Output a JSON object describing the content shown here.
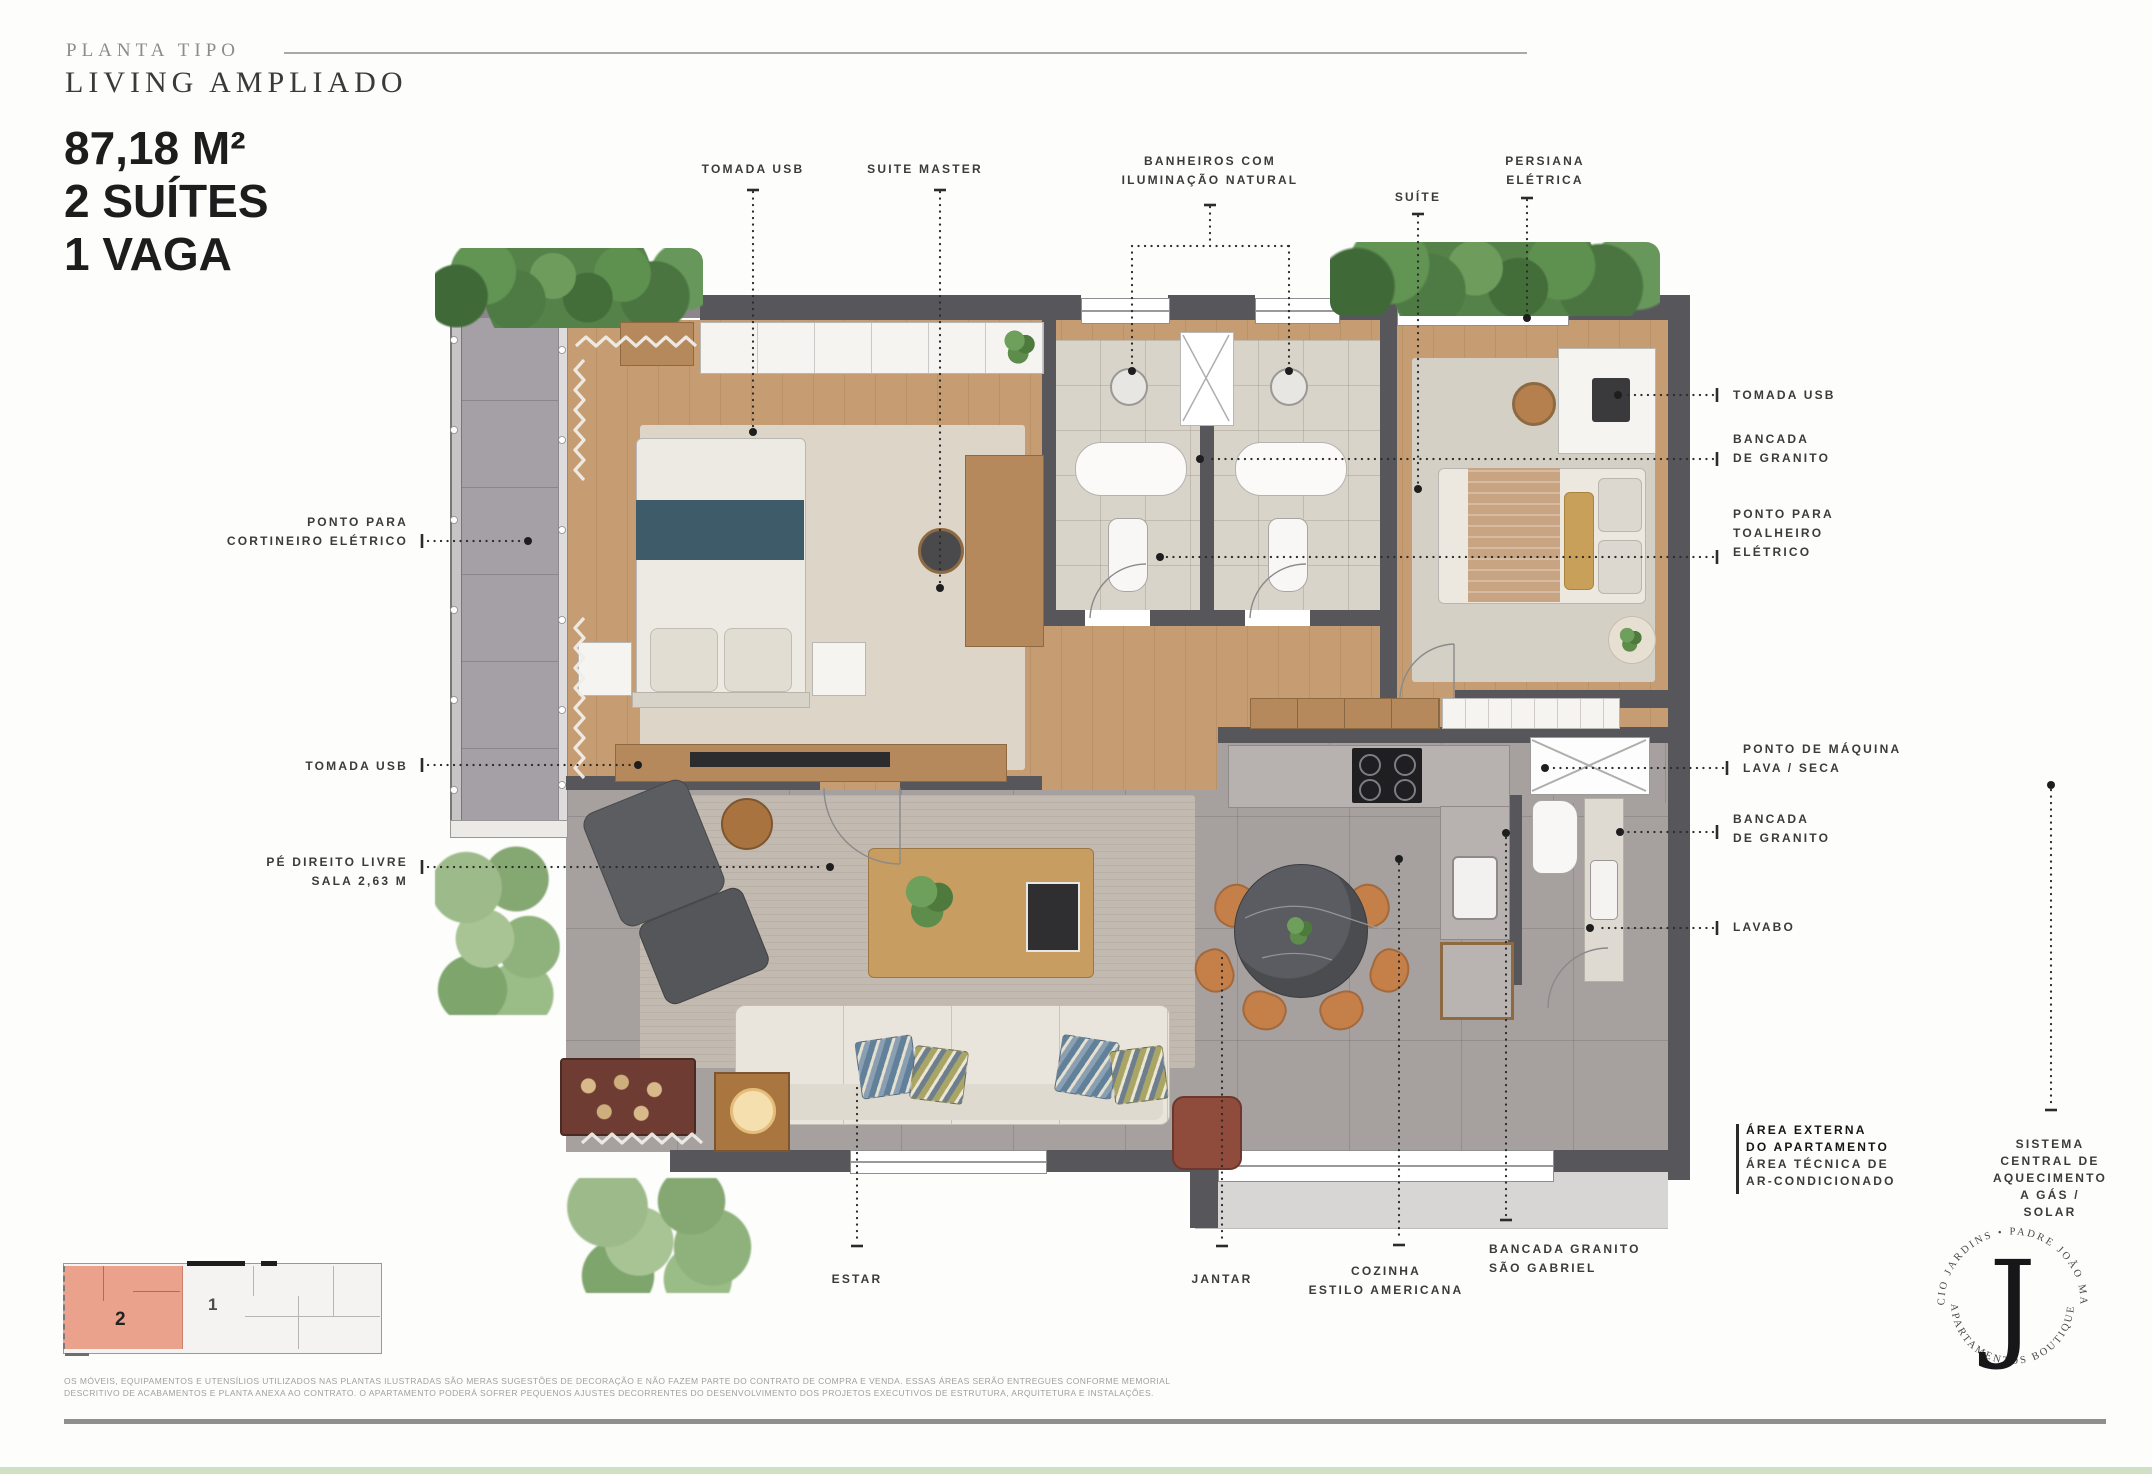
{
  "header": {
    "eyebrow": "PLANTA TIPO",
    "title": "LIVING AMPLIADO",
    "stat_area": "87,18 M²",
    "stat_suites": "2 SUÍTES",
    "stat_parking": "1 VAGA"
  },
  "callouts": {
    "top": {
      "tomada_usb": "TOMADA USB",
      "suite_master": "SUITE MASTER",
      "banheiros": "BANHEIROS COM\nILUMINAÇÃO NATURAL",
      "suite": "SUÍTE",
      "persiana": "PERSIANA\nELÉTRICA"
    },
    "left": {
      "cortineiro": "PONTO PARA\nCORTINEIRO ELÉTRICO",
      "tomada_usb": "TOMADA USB",
      "pe_direito": "PÉ DIREITO LIVRE\nSALA 2,63 M"
    },
    "right": {
      "tomada_usb": "TOMADA USB",
      "bancada_granito_1": "BANCADA\nDE GRANITO",
      "toalheiro": "PONTO PARA\nTOALHEIRO\nELÉTRICO",
      "lava_seca": "PONTO DE MÁQUINA\nLAVA / SECA",
      "bancada_granito_2": "BANCADA\nDE GRANITO",
      "lavabo": "LAVABO"
    },
    "bottom": {
      "estar": "ESTAR",
      "jantar": "JANTAR",
      "cozinha": "COZINHA\nESTILO AMERICANA",
      "bancada_sao_gabriel": "BANCADA GRANITO\nSÃO GABRIEL",
      "area_externa_bold": "ÁREA EXTERNA\nDO APARTAMENTO",
      "area_externa_reg": "ÁREA TÉCNICA DE\nAR-CONDICIONADO",
      "sistema": "SISTEMA CENTRAL DE\nAQUECIMENTO A GÁS /\nSOLAR"
    }
  },
  "key_plan": {
    "unit_highlighted": "2",
    "unit_other": "1",
    "highlight_color": "#EBA28D"
  },
  "logo": {
    "monogram": "J",
    "arc_top": "EDIFÍCIO JARDINS • PADRE JOÃO MANUEL",
    "arc_bottom": "• APARTAMENTOS BOUTIQUE •"
  },
  "footer": {
    "disclaimer_line1": "OS MÓVEIS, EQUIPAMENTOS E UTENSÍLIOS UTILIZADOS NAS PLANTAS ILUSTRADAS SÃO MERAS SUGESTÕES DE DECORAÇÃO E NÃO FAZEM PARTE DO CONTRATO DE COMPRA E VENDA. ESSAS ÁREAS SERÃO ENTREGUES CONFORME MEMORIAL",
    "disclaimer_line2": "DESCRITIVO DE ACABAMENTOS E PLANTA ANEXA AO CONTRATO. O APARTAMENTO PODERÁ SOFRER PEQUENOS AJUSTES DECORRENTES DO DESENVOLVIMENTO DOS PROJETOS EXECUTIVOS DE ESTRUTURA, ARQUITETURA E INSTALAÇÕES."
  },
  "colors": {
    "wall": "#57575B",
    "wood_floor": "#C69D72",
    "accent_unit": "#EBA28D",
    "bed_runner_teal": "#3D5B69"
  }
}
